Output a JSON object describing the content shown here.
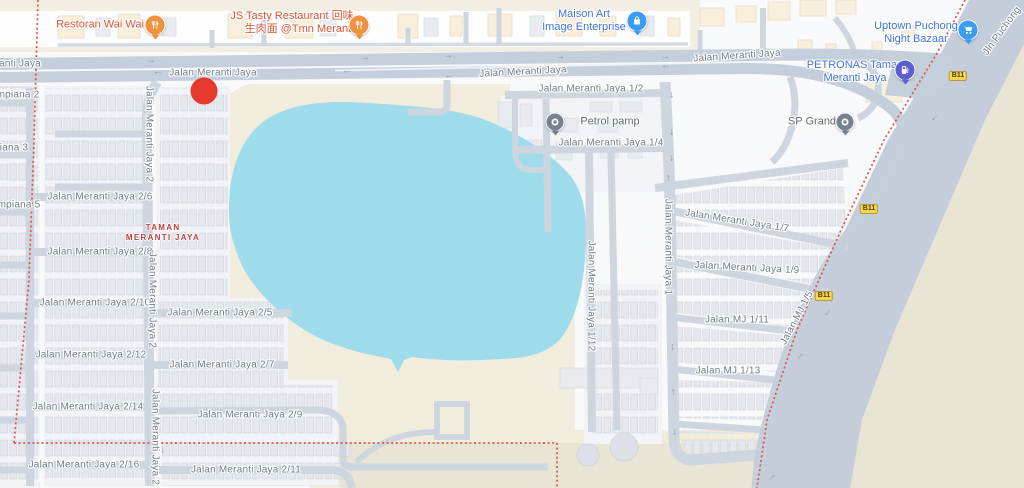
{
  "map": {
    "area_name": "Taman Meranti Jaya, Puchong",
    "colors": {
      "road": "#cdd5de",
      "major_road": "#c5cedb",
      "water": "#9edcec",
      "terrain": "#f1ecdc",
      "terrain_dark": "#e9e5d5",
      "outside_land": "#e8e4d4",
      "boundary_red": "#e15348",
      "street_text": "#6d7c8b",
      "poi_blue": "#4273db",
      "poi_orange": "#db5434",
      "poi_gray": "#5d6b75",
      "region_red": "#bc403a",
      "marker_red": "#e63a2e",
      "badge_yellow": "#fbd54b"
    },
    "region_label": {
      "line1": "TAMAN",
      "line2": "MERANTI JAYA"
    },
    "marker": {
      "name": "selected-location",
      "x": 204,
      "y": 91
    },
    "pois": [
      {
        "id": "restoran-wai-wai",
        "lines": [
          "Restoran Wai Wai"
        ],
        "align": "right",
        "text_x": 100,
        "text_y": 25,
        "color": "#db5434",
        "icon": "fork-knife",
        "icon_color": "#f0913c",
        "icon_size": 19,
        "marker_x": 155,
        "marker_y": 25
      },
      {
        "id": "js-tasty-restaurant",
        "lines": [
          "JS Tasty Restaurant 回味",
          "生肉面 @Tmn Meranti"
        ],
        "align": "right",
        "text_x": 292,
        "text_y": 23,
        "color": "#db5434",
        "icon": "fork-knife",
        "icon_color": "#f0913c",
        "icon_size": 19,
        "marker_x": 359,
        "marker_y": 25
      },
      {
        "id": "maison-art-image-enterprise",
        "lines": [
          "Maison Art",
          "Image Enterprise"
        ],
        "align": "center",
        "text_x": 584,
        "text_y": 21,
        "color": "#4273db",
        "icon": "bag",
        "icon_color": "#3b9df2",
        "icon_size": 19,
        "marker_x": 637,
        "marker_y": 21
      },
      {
        "id": "uptown-puchong-night-bazaar",
        "lines": [
          "Uptown Puchong",
          "Night Bazaar"
        ],
        "align": "center",
        "text_x": 916,
        "text_y": 33,
        "color": "#4273db",
        "icon": "cart",
        "icon_color": "#3b9df2",
        "icon_size": 19,
        "marker_x": 968,
        "marker_y": 30
      },
      {
        "id": "petronas-taman-meranti-jaya",
        "lines": [
          "PETRONAS Taman",
          "Meranti Jaya"
        ],
        "align": "center",
        "text_x": 855,
        "text_y": 72,
        "color": "#4273db",
        "icon": "fuel",
        "icon_color": "#5c5fd1",
        "icon_size": 19,
        "marker_x": 905,
        "marker_y": 70
      },
      {
        "id": "petrol-pamp",
        "lines": [
          "Petrol pamp"
        ],
        "align": "left",
        "text_x": 610,
        "text_y": 122,
        "color": "#5d6b75",
        "icon": "dot",
        "icon_color": "#78828e",
        "icon_size": 17,
        "marker_x": 555,
        "marker_y": 122
      },
      {
        "id": "sp-grand",
        "lines": [
          "SP Grand"
        ],
        "align": "right",
        "text_x": 812,
        "text_y": 122,
        "color": "#5d6b75",
        "icon": "dot",
        "icon_color": "#78828e",
        "icon_size": 17,
        "marker_x": 845,
        "marker_y": 122
      }
    ],
    "street_labels": [
      {
        "text": "anti Jaya",
        "x": 20,
        "y": 64
      },
      {
        "text": "Jalan Meranti Jaya",
        "x": 213,
        "y": 73
      },
      {
        "text": "Jalan Meranti Jaya",
        "x": 523,
        "y": 72,
        "rot": -3
      },
      {
        "text": "Jalan Meranti Jaya",
        "x": 737,
        "y": 56,
        "rot": -4
      },
      {
        "text": "Jalan Meranti Jaya 1/2",
        "x": 591,
        "y": 89
      },
      {
        "text": "Jalan Meranti Jaya 1/4",
        "x": 611,
        "y": 143
      },
      {
        "text": "Jalan Meranti Jaya 1/7",
        "x": 737,
        "y": 221,
        "rot": 9
      },
      {
        "text": "Jalan Meranti Jaya 1/9",
        "x": 747,
        "y": 268,
        "rot": 3
      },
      {
        "text": "Jalan MJ 1/11",
        "x": 737,
        "y": 320
      },
      {
        "text": "Jalan MJ 1/13",
        "x": 728,
        "y": 371
      },
      {
        "text": "mpiana 2",
        "x": 18,
        "y": 95
      },
      {
        "text": "iana 3",
        "x": 14,
        "y": 148
      },
      {
        "text": "mpiana 5",
        "x": 19,
        "y": 205
      },
      {
        "text": "Jalan Meranti Jaya 2/6",
        "x": 100,
        "y": 197
      },
      {
        "text": "Jalan Meranti Jaya 2/8",
        "x": 100,
        "y": 252
      },
      {
        "text": "Jalan Meranti Jaya 2/10",
        "x": 95,
        "y": 303
      },
      {
        "text": "Jalan Meranti Jaya 2/12",
        "x": 91,
        "y": 355
      },
      {
        "text": "Jalan Meranti Jaya 2/14",
        "x": 88,
        "y": 407
      },
      {
        "text": "Jalan Meranti Jaya 2/16",
        "x": 84,
        "y": 465
      },
      {
        "text": "Jalan Meranti Jaya 2/5",
        "x": 220,
        "y": 313
      },
      {
        "text": "Jalan Meranti Jaya 2/7",
        "x": 222,
        "y": 365
      },
      {
        "text": "Jalan Meranti Jaya 2/9",
        "x": 250,
        "y": 415
      },
      {
        "text": "Jalan Meranti Jaya 2/11",
        "x": 246,
        "y": 470
      }
    ],
    "vertical_labels": [
      {
        "text": "Jalan Meranti Jaya 2",
        "x": 149,
        "y": 134,
        "rot": 90
      },
      {
        "text": "Jalan Meranti Jaya 2",
        "x": 152,
        "y": 300,
        "rot": 90
      },
      {
        "text": "Jalan Meranti Jaya 2",
        "x": 155,
        "y": 437,
        "rot": 90
      },
      {
        "text": "Jalan Meranti Jaya 1",
        "x": 668,
        "y": 247,
        "rot": 90
      },
      {
        "text": "Jalan Meranti Jaya 1/12",
        "x": 591,
        "y": 296,
        "rot": 90
      },
      {
        "text": "Jalan MJ 1/5",
        "x": 797,
        "y": 318,
        "rot": -62
      },
      {
        "text": "Jln Puchong",
        "x": 1002,
        "y": 31,
        "rot": -54
      }
    ],
    "route_badges": [
      {
        "text": "B11",
        "x": 958,
        "y": 76
      },
      {
        "text": "B11",
        "x": 869,
        "y": 209
      },
      {
        "text": "B11",
        "x": 824,
        "y": 296
      }
    ],
    "arrows": [
      {
        "x": 151,
        "y": 61,
        "r": 0
      },
      {
        "x": 365,
        "y": 58,
        "r": 0
      },
      {
        "x": 448,
        "y": 56,
        "r": 0
      },
      {
        "x": 560,
        "y": 57,
        "r": 0
      },
      {
        "x": 665,
        "y": 57,
        "r": 0
      },
      {
        "x": 158,
        "y": 73,
        "r": 180
      },
      {
        "x": 347,
        "y": 72,
        "r": 180
      },
      {
        "x": 449,
        "y": 77,
        "r": 180
      },
      {
        "x": 666,
        "y": 67,
        "r": 180
      },
      {
        "x": 672,
        "y": 95,
        "r": 90
      },
      {
        "x": 672,
        "y": 132,
        "r": 90
      },
      {
        "x": 672,
        "y": 158,
        "r": 90
      },
      {
        "x": 673,
        "y": 347,
        "r": 90
      },
      {
        "x": 675,
        "y": 432,
        "r": 90
      },
      {
        "x": 163,
        "y": 450,
        "r": 90
      },
      {
        "x": 668,
        "y": 178,
        "r": 270
      },
      {
        "x": 152,
        "y": 253,
        "r": 270
      },
      {
        "x": 673,
        "y": 392,
        "r": 270
      },
      {
        "x": 935,
        "y": 118,
        "r": 135
      },
      {
        "x": 828,
        "y": 313,
        "r": 135
      },
      {
        "x": 800,
        "y": 356,
        "r": -45
      },
      {
        "x": 772,
        "y": 477,
        "r": -45
      }
    ]
  }
}
